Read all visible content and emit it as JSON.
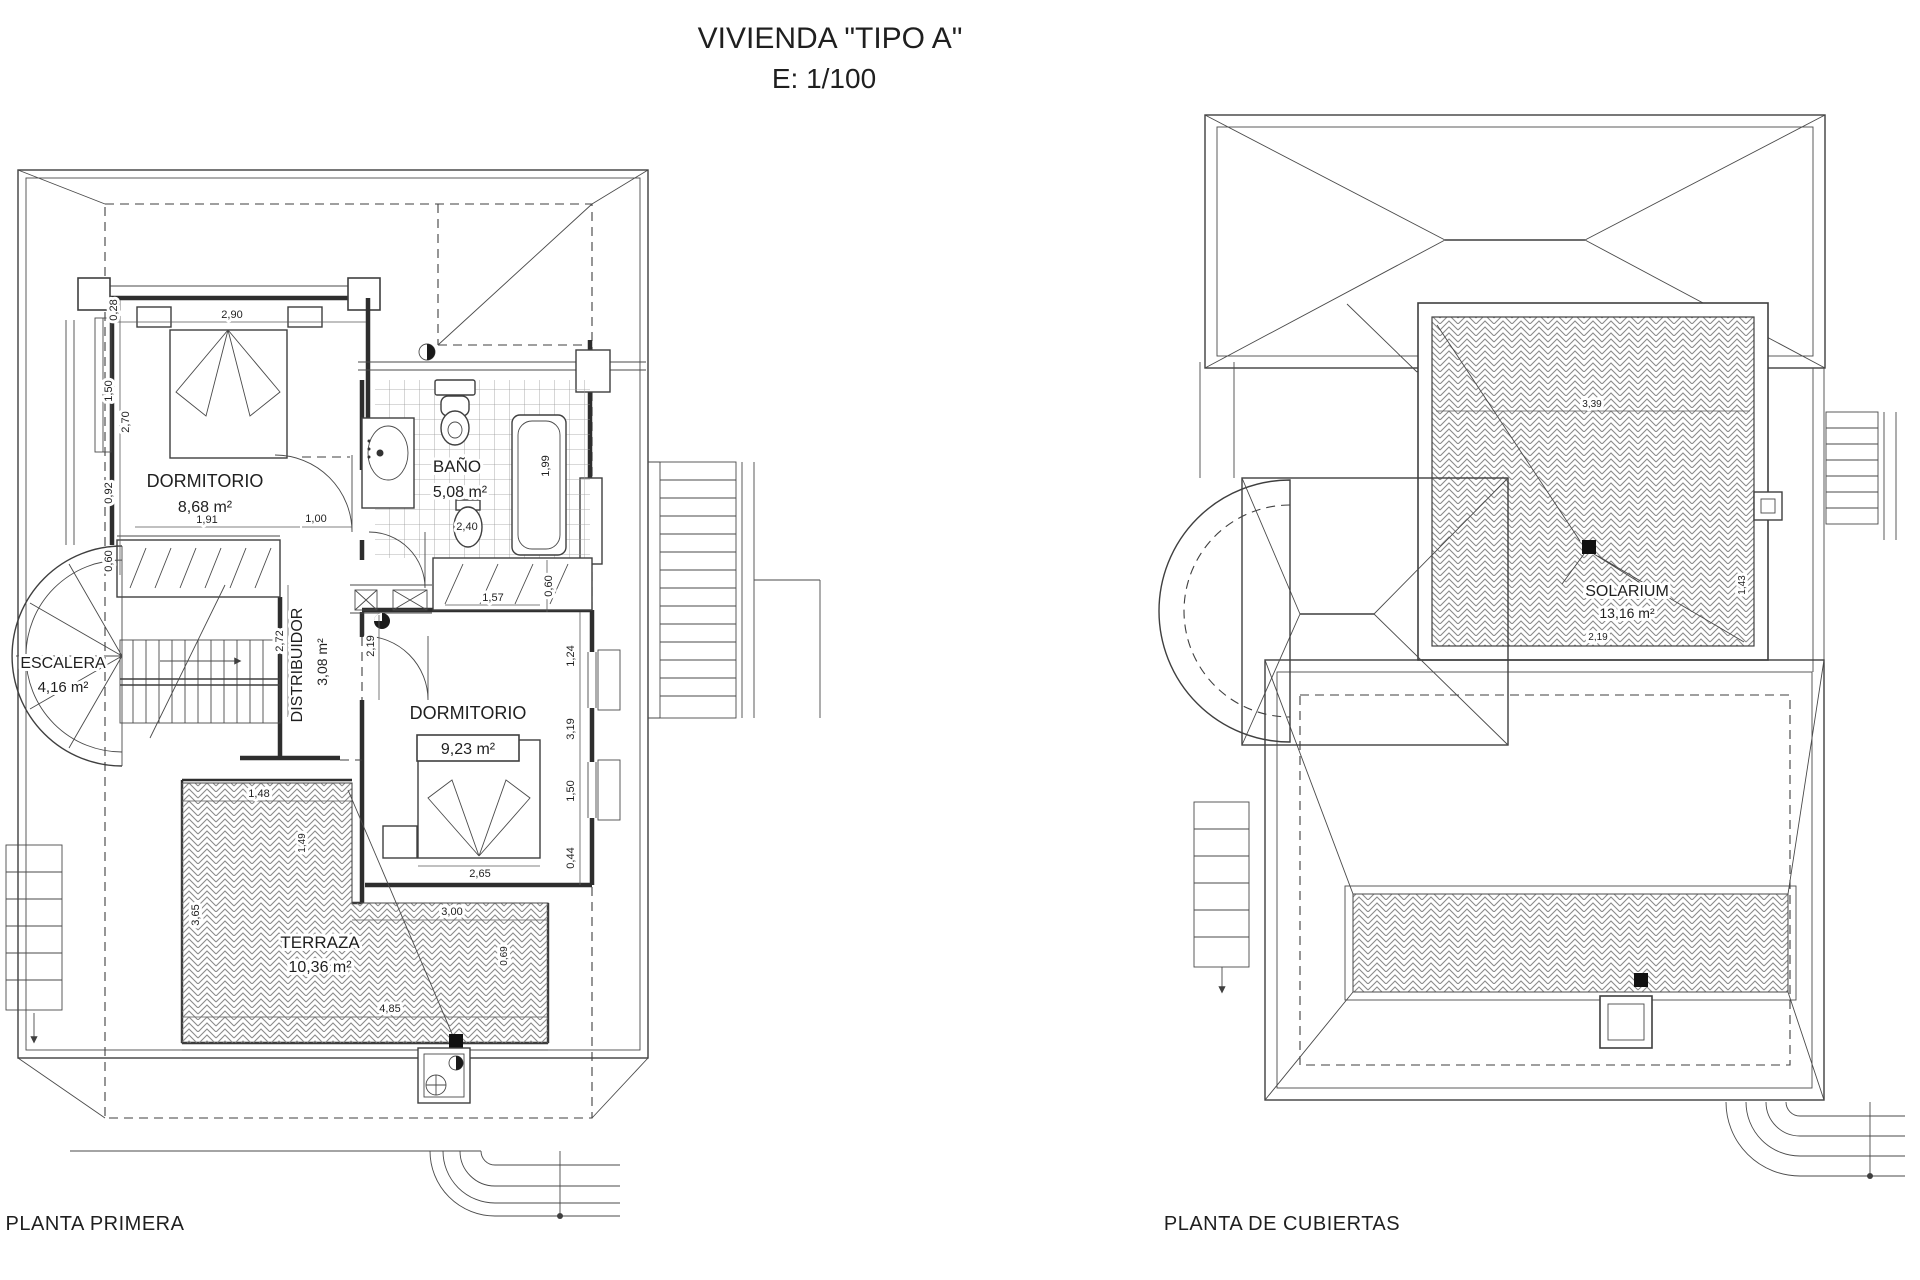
{
  "title": {
    "line1": "VIVIENDA \"TIPO A\"",
    "line2": "E: 1/100"
  },
  "first_floor": {
    "caption": "PLANTA PRIMERA",
    "rooms": {
      "dormitorio1": {
        "name": "DORMITORIO",
        "area": "8,68 m²"
      },
      "bano": {
        "name": "BAÑO",
        "area": "5,08 m²"
      },
      "escalera": {
        "name": "ESCALERA",
        "area": "4,16 m²"
      },
      "distribuidor": {
        "name": "DISTRIBUIDOR",
        "area": "3,08 m²"
      },
      "dormitorio2": {
        "name": "DORMITORIO",
        "area": "9,23 m²"
      },
      "terraza": {
        "name": "TERRAZA",
        "area": "10,36 m²"
      }
    },
    "dims": {
      "w290": "2,90",
      "w028": "0,28",
      "w150": "1,50",
      "w270": "2,70",
      "w092": "0,92",
      "w060": "0,60",
      "w191": "1,91",
      "w100": "1,00",
      "w240": "2,40",
      "w199": "1,99",
      "w157": "1,57",
      "w060b": "0,60",
      "w272": "2,72",
      "w219": "2,19",
      "w124": "1,24",
      "w319": "3,19",
      "w150b": "1,50",
      "w044": "0,44",
      "w265": "2,65",
      "w148": "1,48",
      "w149": "1,49",
      "w365": "3,65",
      "w300": "3,00",
      "w485": "4,85",
      "w069": "0,69"
    }
  },
  "roof": {
    "caption": "PLANTA DE CUBIERTAS",
    "rooms": {
      "solarium": {
        "name": "SOLARIUM",
        "area": "13,16 m²"
      }
    },
    "dims": {
      "w339": "3,39",
      "w143": "1,43",
      "w219": "2,19"
    }
  },
  "colors": {
    "line": "#3f3f3f",
    "hatch": "#8a8a8a",
    "background": "#ffffff"
  }
}
